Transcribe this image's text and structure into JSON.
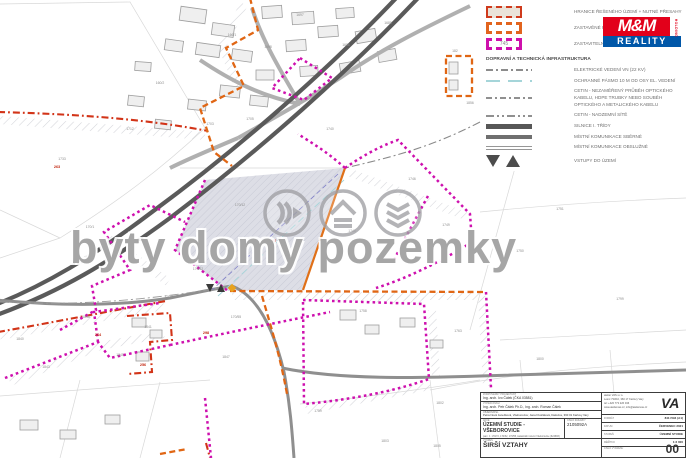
{
  "colors": {
    "magenta": "#ce10ae",
    "orange": "#e06614",
    "red_boundary": "#d23418",
    "road_dark": "#5a5a5a",
    "teal": "#a5d5d9",
    "shaded_fill": "#d9dae3",
    "logo_red": "#e2001a",
    "logo_blue": "#0057a8"
  },
  "watermark": {
    "text": "byty domy pozemky"
  },
  "logo": {
    "mm": "M&M",
    "holding": "HOLDING",
    "reality": "REALITY"
  },
  "legend": {
    "area_items": [
      {
        "label": "HRANICE ŘEŠENÉHO ÚZEMÍ + NUTNÉ PŘESAHY",
        "swatch": "red-dashed-filled-rect"
      },
      {
        "label": "ZASTAVĚNÉ ÚZEMÍ",
        "swatch": "orange-dashed-frame"
      },
      {
        "label": "ZASTAVITELNÁ PLOCHA",
        "swatch": "magenta-dashed-frame",
        "swatch_text": "745"
      }
    ],
    "section_title": "DOPRAVNÍ A TECHNICKÁ INFRASTRUKTURA",
    "line_items": [
      {
        "label": "ELEKTRICKÉ VEDENÍ VN (22 kV)",
        "style": "gray-dash-dot"
      },
      {
        "label": "OCHRANNÉ PÁSMO 10 m OD OSY EL. VEDENÍ",
        "style": "teal-dashed"
      },
      {
        "label": "CETIN - NEZAMĚŘENÝ PRŮBĚH OPTICKÉHO KABELU, HDPE TRUBKY NEBO SOUBĚH OPTICKÉHO A METALICKÉHO KABELU",
        "style": "gray-dashed-markers"
      },
      {
        "label": "CETIN - NADZEMNÍ SÍTĚ",
        "style": "gray-long-dash"
      },
      {
        "label": "SILNICE I. TŘÍDY",
        "style": "thick-bar"
      },
      {
        "label": "MÍSTNÍ KOMUNIKACE SBĚRNÉ",
        "style": "medium-bar"
      },
      {
        "label": "MÍSTNÍ KOMUNIKACE OBSLUŽNÉ",
        "style": "double-thin-bar"
      },
      {
        "label": "VSTUPY DO ÚZEMÍ",
        "style": "triangles"
      }
    ]
  },
  "titleblock": {
    "fields_left": [
      {
        "label": "ZODPOVĚDNÝ PROJEKTANT",
        "value": "Ing. arch. Ivo Čálek (ČKA 03581)"
      },
      {
        "label": "VYPRACOVALI",
        "value": "Ing. arch. Petr Čálek Ph.D., Ing. arch. Roman Čálek"
      },
      {
        "label": "OBJEDNATEL",
        "value": "Petra Nová Janečková, Všeborovice; Jana Dvořáková, Dalovice, 360 01 Karlovy Vary"
      }
    ],
    "project": {
      "label": "AKCE",
      "title": "ÚZEMNÍ STUDIE - VŠEBOROVICE",
      "subtitle": "parc. č. 170/72, 170/52, 170/55, katastrální území Všeborovice (624683)"
    },
    "order": {
      "label": "ČÍSLO ZAKÁZKY",
      "value": "2105092A"
    },
    "drawing": {
      "label": "VÝKRES",
      "value": "ŠIRŠÍ VZTAHY"
    },
    "company": {
      "lines": [
        "atelier VAS s.r.o.",
        "Lesní 733/10, 360 17 Karlovy Vary",
        "tel: +420 773 226 046",
        "www.ateliervas.cz, info@ateliervas.cz"
      ],
      "logo": "VA"
    },
    "fields_right": [
      {
        "label": "FORMÁT",
        "value": "841×594 (A1)"
      },
      {
        "label": "DATUM",
        "value": "ČERVENEC 2021"
      },
      {
        "label": "STUPEŇ",
        "value": "ÚZEMNÍ STUDIE"
      },
      {
        "label": "MĚŘÍTKO",
        "value": "1:2 000"
      }
    ],
    "sheet": {
      "label": "ČÍSLO VÝKRESU",
      "value": "00"
    }
  },
  "map": {
    "labels": [
      {
        "x": 62,
        "y": 160,
        "t": "1733"
      },
      {
        "x": 300,
        "y": 16,
        "t": "1697"
      },
      {
        "x": 268,
        "y": 48,
        "t": "1698"
      },
      {
        "x": 388,
        "y": 24,
        "t": "1685"
      },
      {
        "x": 346,
        "y": 46,
        "t": "1686"
      },
      {
        "x": 232,
        "y": 36,
        "t": "166/1"
      },
      {
        "x": 160,
        "y": 84,
        "t": "160/2"
      },
      {
        "x": 130,
        "y": 130,
        "t": "1712"
      },
      {
        "x": 250,
        "y": 120,
        "t": "1705"
      },
      {
        "x": 210,
        "y": 125,
        "t": "1703"
      },
      {
        "x": 455,
        "y": 52,
        "t": "182"
      },
      {
        "x": 470,
        "y": 104,
        "t": "1856"
      },
      {
        "x": 240,
        "y": 206,
        "t": "170/12"
      },
      {
        "x": 287,
        "y": 256,
        "t": "170/19"
      },
      {
        "x": 198,
        "y": 270,
        "t": "170/52"
      },
      {
        "x": 170,
        "y": 298,
        "t": "170/72"
      },
      {
        "x": 236,
        "y": 318,
        "t": "170/55"
      },
      {
        "x": 352,
        "y": 232,
        "t": "1745"
      },
      {
        "x": 412,
        "y": 180,
        "t": "1746"
      },
      {
        "x": 446,
        "y": 226,
        "t": "1749"
      },
      {
        "x": 520,
        "y": 252,
        "t": "1750"
      },
      {
        "x": 363,
        "y": 312,
        "t": "1758"
      },
      {
        "x": 458,
        "y": 332,
        "t": "1763"
      },
      {
        "x": 318,
        "y": 412,
        "t": "1759"
      },
      {
        "x": 440,
        "y": 404,
        "t": "1802"
      },
      {
        "x": 385,
        "y": 442,
        "t": "1803"
      },
      {
        "x": 437,
        "y": 447,
        "t": "1805"
      },
      {
        "x": 300,
        "y": 372,
        "t": "1764"
      },
      {
        "x": 46,
        "y": 368,
        "t": "1843"
      },
      {
        "x": 86,
        "y": 318,
        "t": "1846"
      },
      {
        "x": 20,
        "y": 340,
        "t": "1840"
      },
      {
        "x": 148,
        "y": 328,
        "t": "1841"
      },
      {
        "x": 120,
        "y": 356,
        "t": "1845"
      },
      {
        "x": 226,
        "y": 358,
        "t": "1847"
      },
      {
        "x": 560,
        "y": 210,
        "t": "1751"
      },
      {
        "x": 620,
        "y": 300,
        "t": "1799"
      },
      {
        "x": 540,
        "y": 360,
        "t": "1800"
      },
      {
        "x": 90,
        "y": 228,
        "t": "170/1"
      },
      {
        "x": 330,
        "y": 130,
        "t": "1740"
      },
      {
        "x": 57,
        "y": 168,
        "t": "263",
        "red": 1
      },
      {
        "x": 98,
        "y": 336,
        "t": "264",
        "red": 1
      },
      {
        "x": 273,
        "y": 242,
        "t": "266",
        "red": 1
      },
      {
        "x": 206,
        "y": 334,
        "t": "298",
        "red": 1
      },
      {
        "x": 143,
        "y": 366,
        "t": "256",
        "red": 1
      }
    ]
  }
}
